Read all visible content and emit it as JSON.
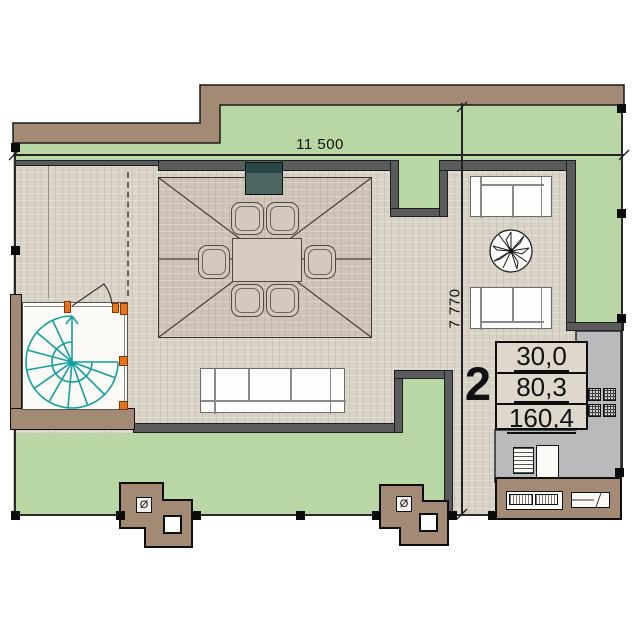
{
  "dimensions": {
    "horizontal_label": "11 500",
    "vertical_label": "7 770"
  },
  "unit": {
    "number": "2",
    "areas": [
      "30,0",
      "80,3",
      "160,4"
    ]
  },
  "symbols": {
    "vent": "Ø"
  },
  "colors": {
    "lawn": "#b9d7a4",
    "floor": "#d9d2c7",
    "floor_dark": "#cfc4b7",
    "wall": "#595b5d",
    "brown": "#a28a75",
    "teal": "#13a09e",
    "orange": "#e8731e",
    "kitchen_gray": "#b8babb",
    "fireplace_dark": "#2b4647",
    "fireplace_light": "#4d6664"
  }
}
